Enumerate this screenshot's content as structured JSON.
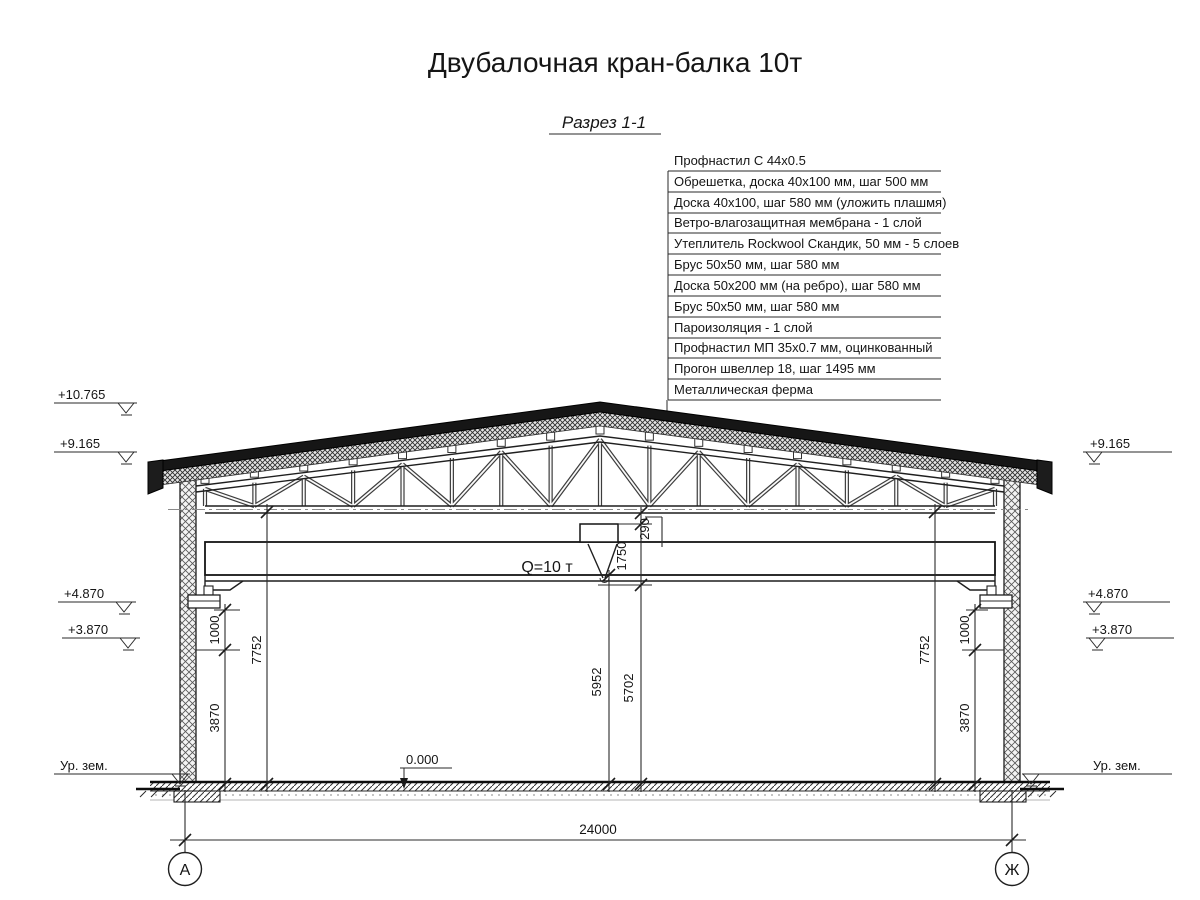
{
  "title": "Двубалочная кран-балка 10т",
  "section": {
    "label": "Разрез 1-1"
  },
  "callout": {
    "items": [
      "Профнастил С 44х0.5",
      "Обрешетка, доска 40х100 мм, шаг 500 мм",
      "Доска 40х100, шаг 580 мм (уложить плашмя)",
      "Ветро-влагозащитная мембрана - 1 слой",
      "Утеплитель Rockwool Скандик, 50 мм - 5 слоев",
      "Брус 50х50 мм, шаг 580 мм",
      "Доска 50х200 мм (на ребро), шаг 580 мм",
      "Брус 50х50 мм, шаг 580 мм",
      "Пароизоляция - 1 слой",
      "Профнастил МП 35х0.7 мм, оцинкованный",
      "Прогон швеллер 18, шаг 1495 мм",
      "Металлическая ферма"
    ]
  },
  "elevation_marks": {
    "left_ridge": "+10.765",
    "left_eave": "+9.165",
    "left_rail": "+4.870",
    "left_bracket": "+3.870",
    "left_ground": "Ур. зем.",
    "floor": "0.000",
    "right_eave": "+9.165",
    "right_rail": "+4.870",
    "right_bracket": "+3.870",
    "right_ground": "Ур. зем."
  },
  "dimensions": {
    "span": "24000",
    "left_chord_height": "7752",
    "right_chord_height": "7752",
    "left_rail_offset": "1000",
    "right_rail_offset": "1000",
    "left_bracket_height": "3870",
    "right_bracket_height": "3870",
    "beam_underside": "5952",
    "hook_height": "5702",
    "hoist_drop": "1750",
    "chord_gap": "290"
  },
  "crane": {
    "capacity": "Q=10 т"
  },
  "axes": {
    "left": "А",
    "right": "Ж"
  }
}
